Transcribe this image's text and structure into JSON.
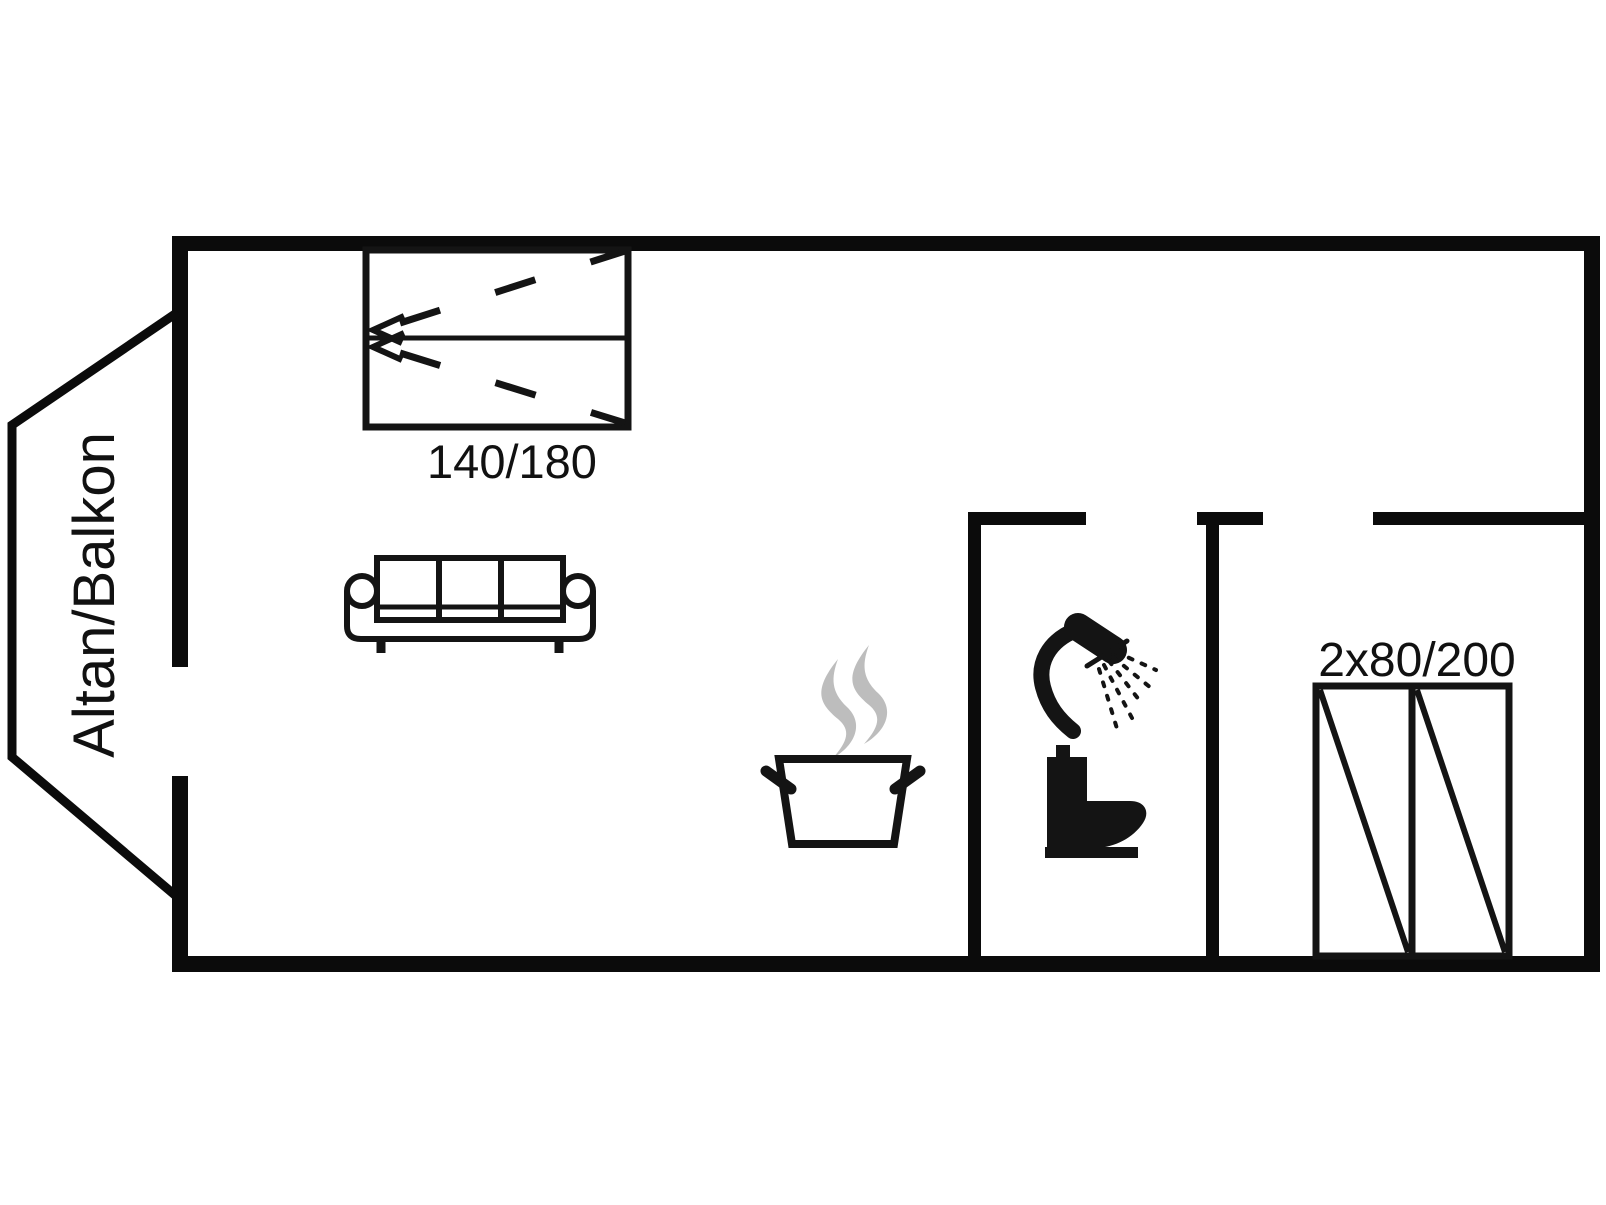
{
  "meta": {
    "kind": "floor-plan",
    "description": "Apartment floor plan with balcony, double bed, sofa, kitchen, bathroom and wardrobe"
  },
  "colors": {
    "background": "#ffffff",
    "walls": "#0b0b0b",
    "furniture": "#141414",
    "steam": "#bdbdbd",
    "text": "#111111"
  },
  "labels": {
    "balcony": "Altan/Balkon",
    "bed_size": "140/180",
    "wardrobe_size": "2x80/200"
  },
  "icons": {
    "bed": "double-bed-icon",
    "sofa": "three-seat-sofa-icon",
    "kitchen": "steaming-pot-icon",
    "shower": "shower-head-icon",
    "toilet": "toilet-icon",
    "wardrobe": "double-wardrobe-icon"
  }
}
